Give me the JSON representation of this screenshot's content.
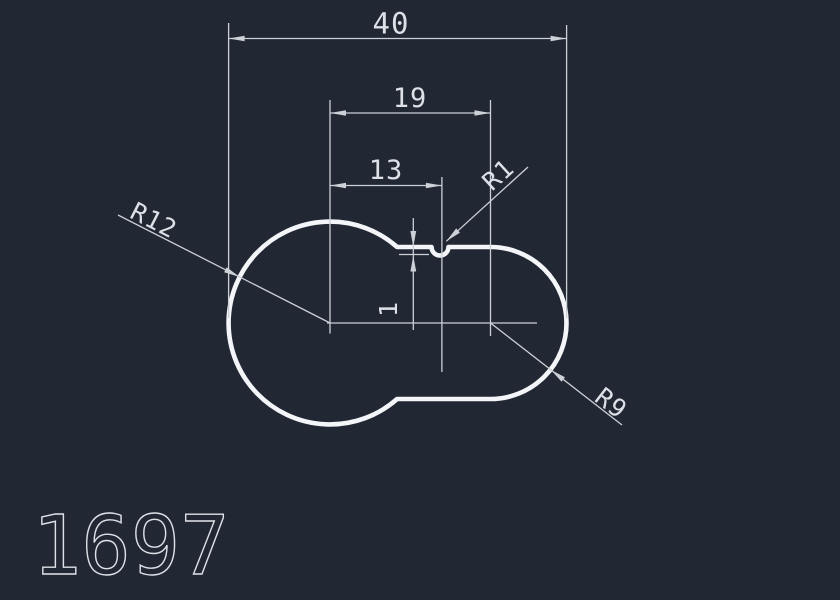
{
  "colors": {
    "background": "#212733",
    "line": "#ccd0d7",
    "outline": "#f3f5f8",
    "text": "#dde0e6"
  },
  "drawing": {
    "number": "1697",
    "dimensions": {
      "total_width": {
        "label": "40"
      },
      "center_distance": {
        "label": "19"
      },
      "notch_offset": {
        "label": "13"
      },
      "notch_depth": {
        "label": "1"
      },
      "radius_large": {
        "label": "R12"
      },
      "radius_small": {
        "label": "R9"
      },
      "radius_notch": {
        "label": "R1"
      }
    }
  }
}
